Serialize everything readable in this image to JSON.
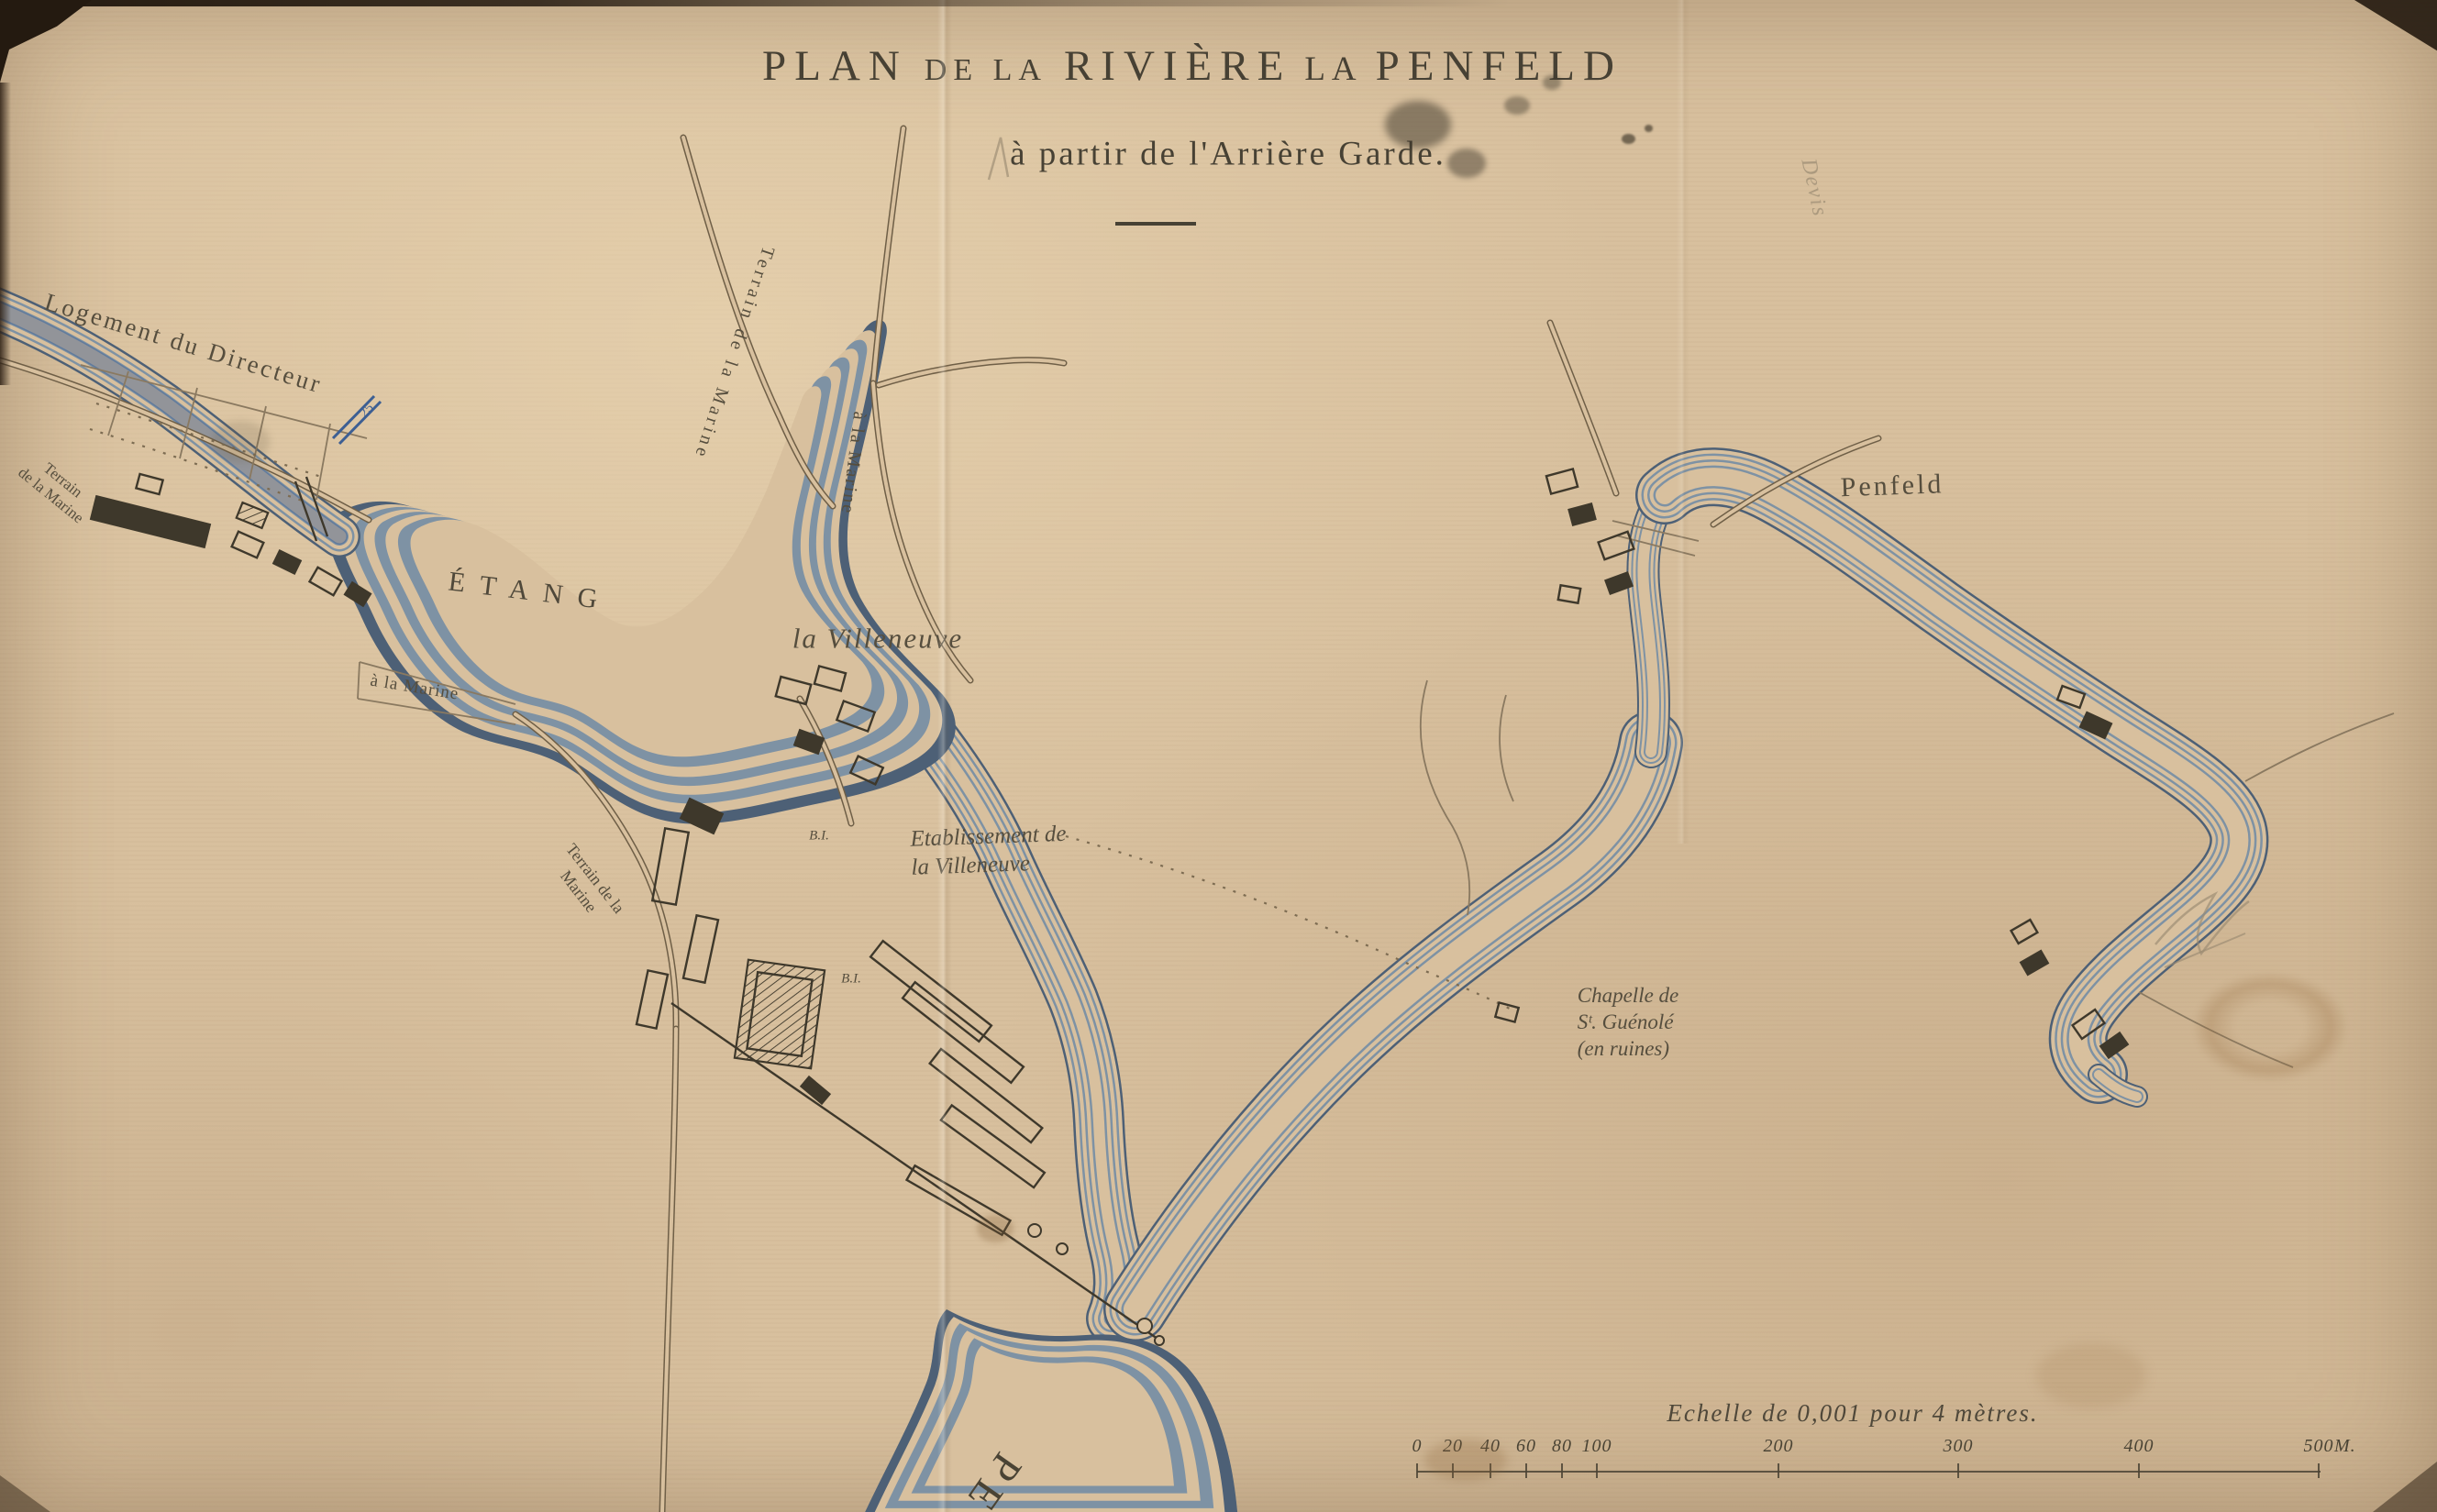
{
  "sheet": {
    "name": "Plan de la riviere la Penfeld"
  },
  "title": {
    "p1": "PLAN",
    "p2": "DE LA",
    "p3": "RIVIÈRE",
    "p4": "LA",
    "p5": "PENFELD",
    "subtitle": "à partir de l'Arrière Garde."
  },
  "labels": {
    "logement": "Logement du Directeur",
    "terrain_left_1": "Terrain",
    "terrain_left_2": "de la Marine",
    "terrain_top": "Terrain de la Marine",
    "a_la_marine_top": "à la Marine",
    "etang": "ÉTANG",
    "a_la_marine_road": "à la Marine",
    "la_villeneuve": "la Villeneuve",
    "terrain_mid_1": "Terrain de la",
    "terrain_mid_2": "Marine",
    "etablissement_1": "Etablissement de",
    "etablissement_2": "la Villeneuve",
    "bi_upper": "B.I.",
    "bi_lower": "B.I.",
    "penfeld": "Penfeld",
    "chapelle_1": "Chapelle de",
    "chapelle_2": "Sᵗ. Guénolé",
    "chapelle_3": "(en ruines)",
    "river_initials": "PE"
  },
  "annotations": {
    "blue_depth": "25",
    "pencil_note": "Devis"
  },
  "scale": {
    "caption": "Echelle de 0,001 pour 4 mètres.",
    "ticks": [
      "0",
      "20",
      "40",
      "60",
      "80",
      "100",
      "200",
      "300",
      "400",
      "500"
    ],
    "unit": "M."
  },
  "colors": {
    "paper": "#d8c09e",
    "ink": "#4a4334",
    "water": "#4d6076",
    "water_light": "#7e92a4",
    "road": "#6f5f47",
    "blue_note": "#3d5f93",
    "pencil": "#9a8b72"
  }
}
